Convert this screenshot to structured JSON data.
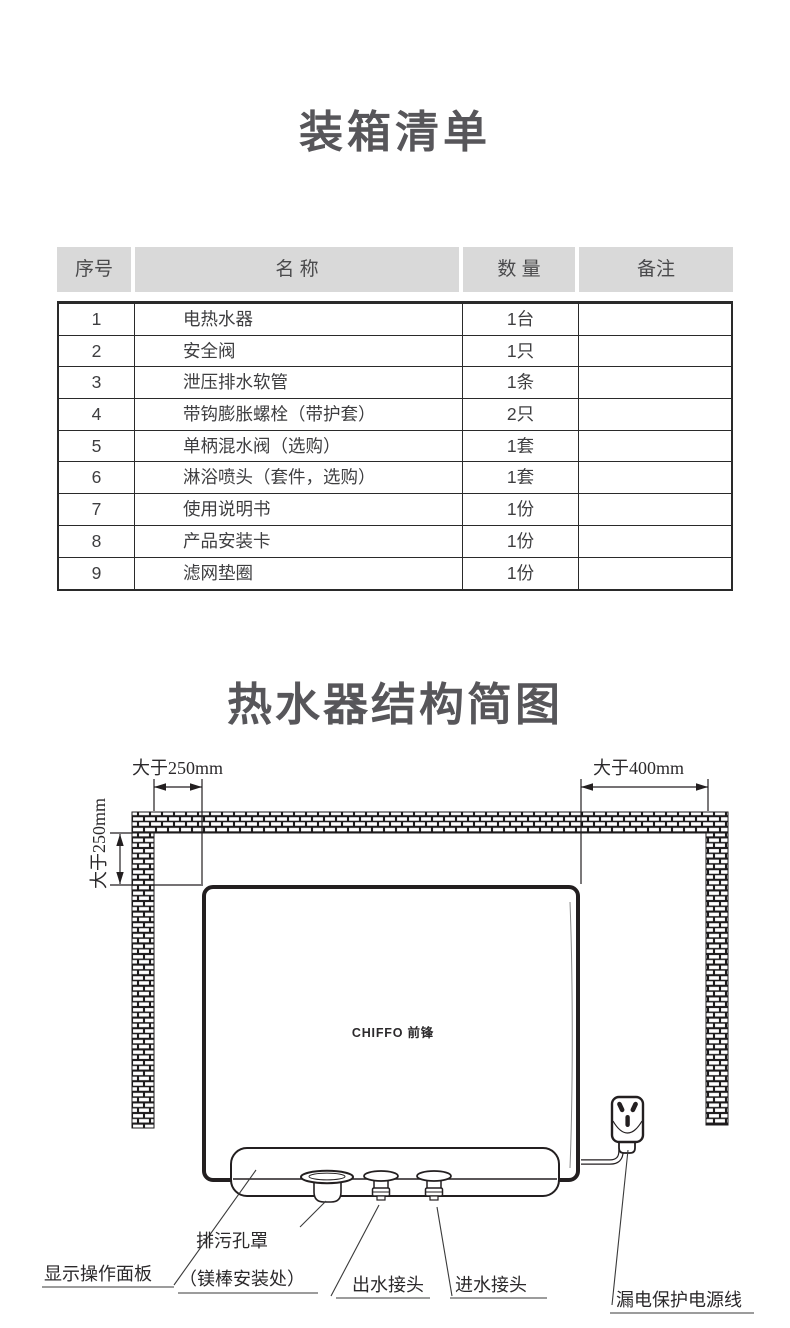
{
  "page": {
    "title_packing": "装箱清单",
    "title_structure": "热水器结构简图"
  },
  "packing_table": {
    "headers": {
      "no": "序号",
      "name": "名 称",
      "qty": "数 量",
      "remark": "备注"
    },
    "rows": [
      {
        "no": "1",
        "name": "电热水器",
        "qty": "1台",
        "remark": ""
      },
      {
        "no": "2",
        "name": "安全阀",
        "qty": "1只",
        "remark": ""
      },
      {
        "no": "3",
        "name": "泄压排水软管",
        "qty": "1条",
        "remark": ""
      },
      {
        "no": "4",
        "name": "带钩膨胀螺栓（带护套）",
        "qty": "2只",
        "remark": ""
      },
      {
        "no": "5",
        "name": "单柄混水阀（选购）",
        "qty": "1套",
        "remark": ""
      },
      {
        "no": "6",
        "name": "淋浴喷头（套件，选购）",
        "qty": "1套",
        "remark": ""
      },
      {
        "no": "7",
        "name": "使用说明书",
        "qty": "1份",
        "remark": ""
      },
      {
        "no": "8",
        "name": "产品安装卡",
        "qty": "1份",
        "remark": ""
      },
      {
        "no": "9",
        "name": "滤网垫圈",
        "qty": "1份",
        "remark": ""
      }
    ]
  },
  "diagram": {
    "dim_top_left": "大于250mm",
    "dim_top_right": "大于400mm",
    "dim_left": "大于250mm",
    "brand_logo": "CHIFFO 前锋",
    "labels": {
      "display_panel": "显示操作面板",
      "drain_line1": "排污孔罩",
      "drain_line2": "（镁棒安装处）",
      "outlet": "出水接头",
      "inlet": "进水接头",
      "power_cord": "漏电保护电源线"
    },
    "colors": {
      "line": "#231f20",
      "table_header_bg": "#d9d9d9",
      "title_text": "#57565a"
    }
  }
}
